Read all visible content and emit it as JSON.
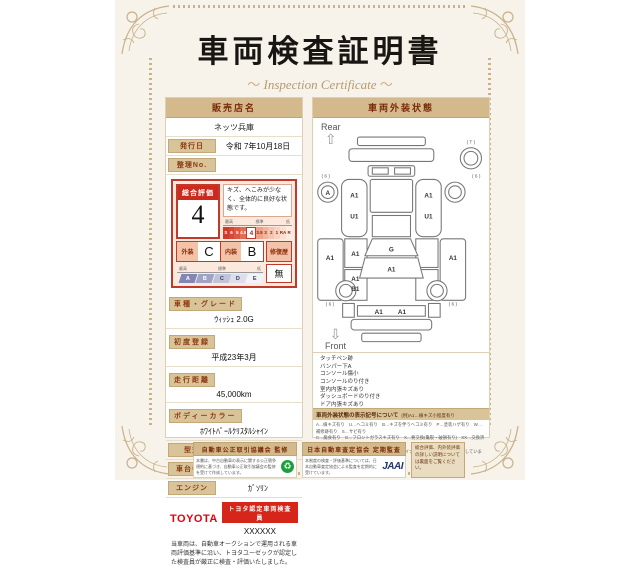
{
  "title": "車両検査証明書",
  "subtitle": "Inspection Certificate",
  "dealer": {
    "header": "販売店名",
    "name": "ネッツ兵庫"
  },
  "meta": {
    "issue_label": "発行日",
    "issue_value": "令和 7年10月18日",
    "ref_label": "整理No.",
    "ref_value": ""
  },
  "rating": {
    "label": "総合評価",
    "value": "4",
    "comment": "キズ、へこみが少なく、全体的に良好な状態です。",
    "scale_high": "最高",
    "scale_mid": "標準",
    "scale_low": "低",
    "scale": [
      "S",
      "6",
      "5",
      "4.5",
      "4",
      "3.5",
      "3",
      "2",
      "1",
      "RA",
      "R"
    ],
    "selected": "4",
    "exterior_label": "外装",
    "exterior_value": "C",
    "interior_label": "内装",
    "interior_value": "B",
    "repair_label": "修復歴",
    "repair_value": "無",
    "grade_high": "最高",
    "grade_mid": "標準",
    "grade_low": "低",
    "grade_scale": [
      "A",
      "B",
      "C",
      "D",
      "E"
    ]
  },
  "specs": [
    {
      "label": "車種・グレード",
      "value": "ｳｨｯｼｭ 2.0G"
    },
    {
      "label": "初度登録",
      "value": "平成23年3月"
    },
    {
      "label": "走行距離",
      "value": "45,000km"
    },
    {
      "label": "ボディーカラー",
      "value": "ﾎﾜｲﾄﾊﾟｰﾙｸﾘｽﾀﾙｼｬｲﾝ"
    }
  ],
  "rows": [
    {
      "label": "型式",
      "value": "ZGE21G-HPXGP"
    },
    {
      "label": "車台番号",
      "value": "XXXXXXXX805"
    },
    {
      "label": "エンジン",
      "value": "ｶﾞｿﾘﾝ"
    }
  ],
  "inspector": {
    "brand": "TOYOTA",
    "badge": "トヨタ認定車両検査員",
    "name": "XXXXXX"
  },
  "disclaimer": "当車両は、自動車オークションで運用される車両評価基準に沿い、トヨタユーゼックが認定した検査員が厳正に検査・評価いたしました。",
  "exterior_panel": {
    "header": "車両外装状態",
    "rear_label": "Rear",
    "front_label": "Front",
    "diagram": {
      "spare": "( T )",
      "wheel_a": "A",
      "mark_rl": "( 6 )",
      "mark_rr": "( 6 )",
      "mark_fl": "( 6 )",
      "mark_fr": "( 6 )",
      "left_door": "A1",
      "left_door2": "U1",
      "right_door": "A1",
      "right_door2": "U1",
      "glass": "G",
      "hood": "A1",
      "left_inner1": "A1",
      "left_inner2": "A1",
      "left_inner2b": "B1",
      "outer_left": "A1",
      "outer_right": "A1",
      "front1": "A1",
      "front2": "A1"
    },
    "notes": [
      "タッチペン跡",
      "バンパー下A",
      "コンソール傷小",
      "コンソールのり付き",
      "室内内張キズあり",
      "ダッシュボードのり付き",
      "ドア内張キズあり"
    ],
    "legend": {
      "header": "車両外装状態の表示記号について",
      "example": "(例)A1…線キズ小程度有り",
      "lines": [
        "A…線キズ有り　U…ヘコミ有り　B…キズを伴うヘコミ有り　P…塗装ハゲ有り　W…補修跡有り　S…サビ有り",
        "C…腐食有り　G…フロントガラスキズ有り　X…要交換(亀裂・破損有り)　XX…交換済有り",
        "1…小程度　2…中程度　3…中程度以上　・マイナー補修箇所は、表記を省略しています。"
      ]
    }
  },
  "footer": {
    "fair_trade": {
      "header": "自動車公正取引協議会 監修",
      "text": "本書は、中古自動車の表示に関する公正競争規約に基づき、自動車公正取引協議会の監修を受けて作成しています。",
      "logo": "♻"
    },
    "jaai": {
      "header": "日本自動車査定協会 定期監査",
      "text": "本制度の検査・評価基準については、日本自動車査定協会による監査を定期的に受けています。",
      "logo": "JAAI"
    },
    "note": "総合評価、内外装評価の詳しい説明については裏面をご覧ください。"
  },
  "colors": {
    "header_tan": "#d3b98c",
    "dark_red": "#8c2e0b",
    "rating_red": "#c0392b",
    "toyota_red": "#e60012",
    "jaai_blue": "#23356e",
    "eco_green": "#1e9e3e"
  }
}
